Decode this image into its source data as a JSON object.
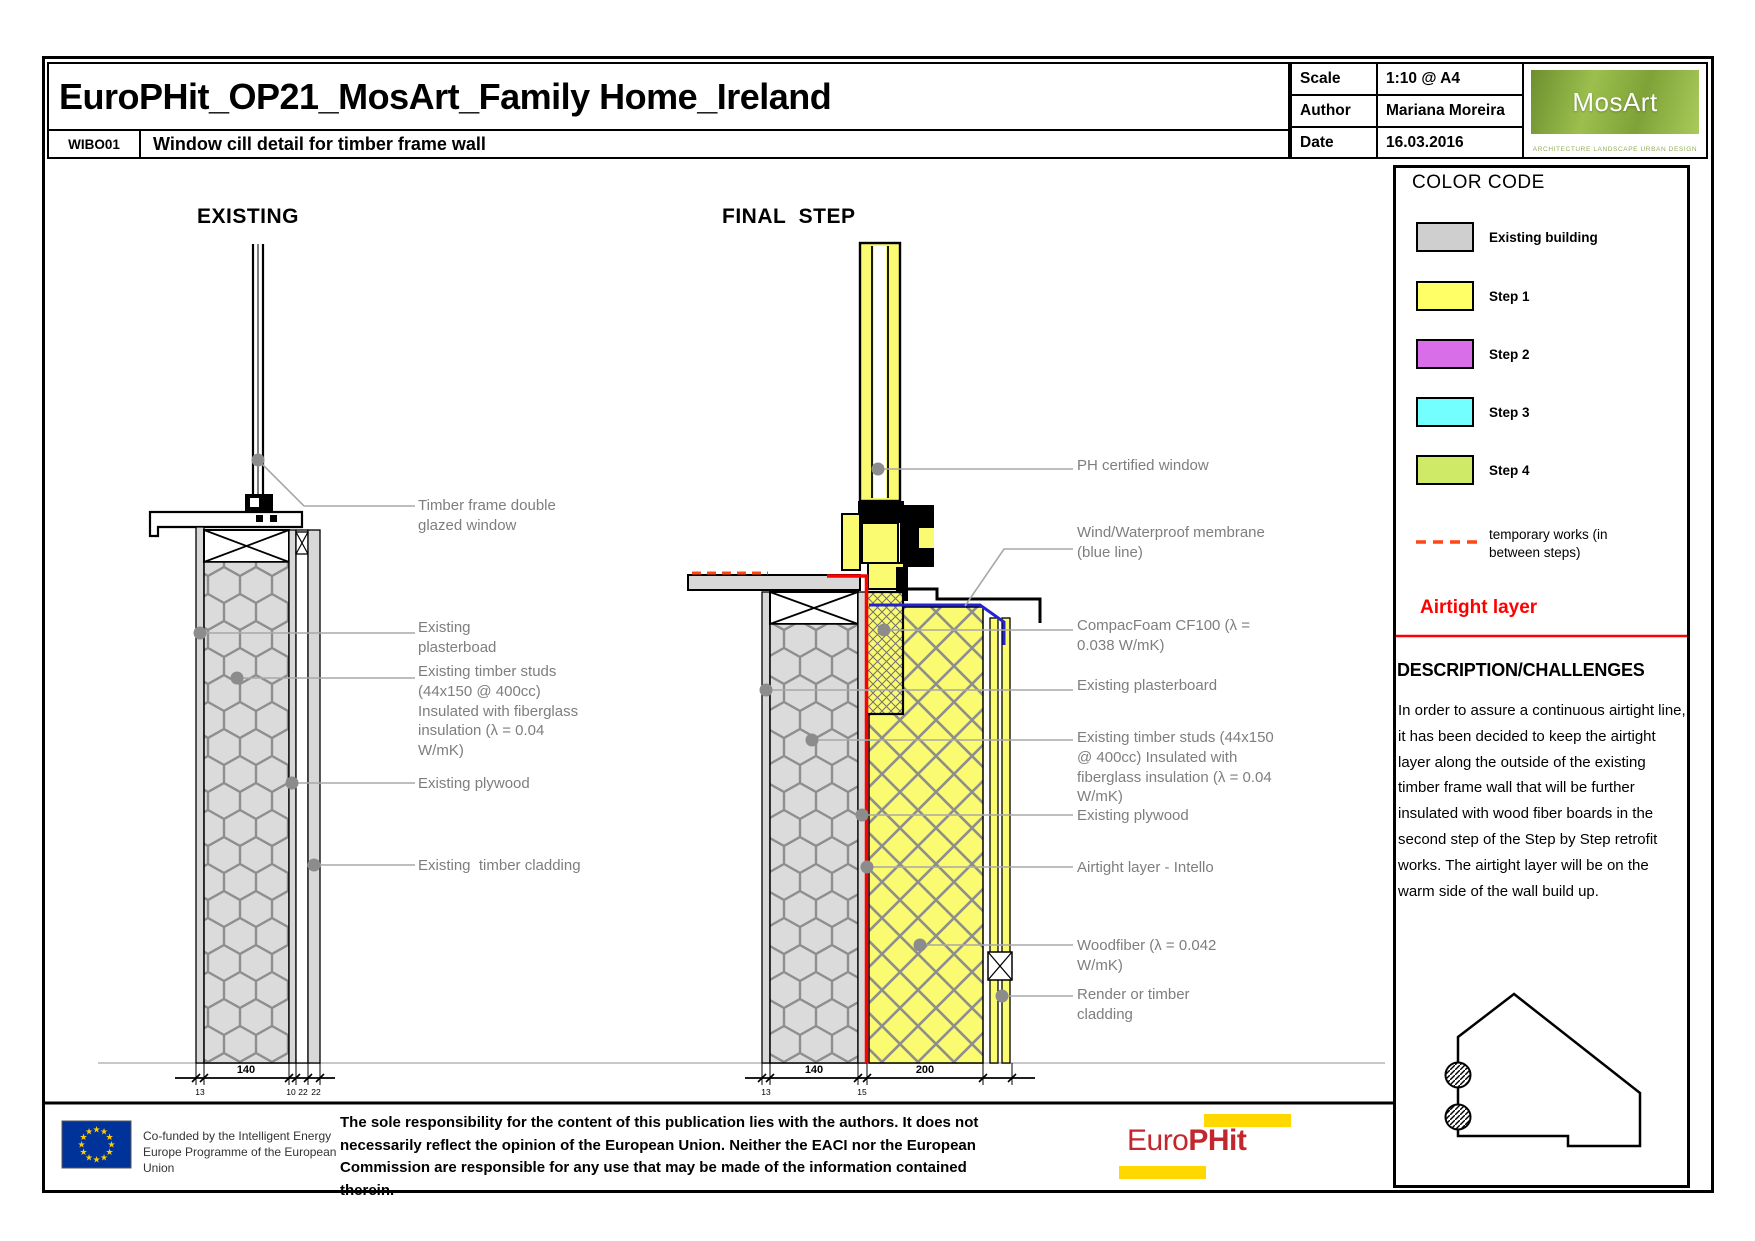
{
  "title_block": {
    "project_title": "EuroPHit_OP21_MosArt_Family Home_Ireland",
    "drawing_code": "WIBO01",
    "drawing_title": "Window cill detail for timber frame wall",
    "scale_label": "Scale",
    "scale_value": "1:10 @ A4",
    "author_label": "Author",
    "author_value": "Mariana Moreira",
    "date_label": "Date",
    "date_value": "16.03.2016",
    "logo_text": "MosArt",
    "logo_caption": "ARCHITECTURE  LANDSCAPE  URBAN DESIGN"
  },
  "drawings": {
    "existing": {
      "heading": "EXISTING",
      "labels": [
        "Timber frame double glazed window",
        "Existing plasterboad",
        "Existing timber studs (44x150 @ 400cc) Insulated with fiberglass insulation (λ = 0.04 W/mK)",
        "Existing plywood",
        "Existing  timber cladding"
      ],
      "dims": [
        "13",
        "140",
        "10",
        "22",
        "22"
      ]
    },
    "final": {
      "heading": "FINAL  STEP",
      "labels": [
        "PH certified window",
        "Wind/Waterproof membrane (blue line)",
        "CompacFoam CF100 (λ = 0.038 W/mK)",
        "Existing plasterboard",
        "Existing timber studs (44x150 @ 400cc) Insulated with fiberglass insulation (λ = 0.04 W/mK)",
        "Existing plywood",
        "Airtight layer - Intello",
        "Woodfiber (λ = 0.042 W/mK)",
        "Render or timber cladding"
      ],
      "dims": [
        "13",
        "140",
        "15",
        "200"
      ]
    }
  },
  "legend": {
    "heading": "COLOR CODE",
    "items": [
      {
        "label": "Existing building",
        "color": "#CFCFCF"
      },
      {
        "label": "Step 1",
        "color": "#FFFF66"
      },
      {
        "label": "Step 2",
        "color": "#D96FE8"
      },
      {
        "label": "Step 3",
        "color": "#73FFFF"
      },
      {
        "label": "Step 4",
        "color": "#CEEA66"
      }
    ],
    "temporary_label": "temporary works (in between steps)"
  },
  "airtight": {
    "heading": "Airtight layer",
    "color": "#FF0000"
  },
  "description": {
    "heading": "DESCRIPTION/CHALLENGES",
    "body": "In order to assure a continuous airtight line, it has been decided to keep the airtight layer along the outside of the existing timber frame wall that will be further insulated with wood fiber boards in the second step of the Step by Step retrofit works. The airtight layer will be on the warm side of the wall build up."
  },
  "footer": {
    "eu_caption": "Co-funded by the Intelligent Energy Europe Programme of the European Union",
    "disclaimer": "The sole responsibility for the content of this publication lies with the authors. It does not necessarily reflect the opinion of the European Union. Neither the EACI nor the European Commission are responsible for any use that may be made of the information contained therein.",
    "europhit_prefix": "Euro",
    "europhit_suffix": "PHit"
  },
  "colors": {
    "step_yellow": "#FBFB72",
    "existing_gray": "#D8D8D8",
    "airtight_red": "#FF0000",
    "temporary_red": "#FF4713",
    "membrane_blue": "#2424CC",
    "eu_flag_blue": "#003399",
    "europhit_yellow": "#FFD800",
    "europhit_red": "#C1272D"
  }
}
